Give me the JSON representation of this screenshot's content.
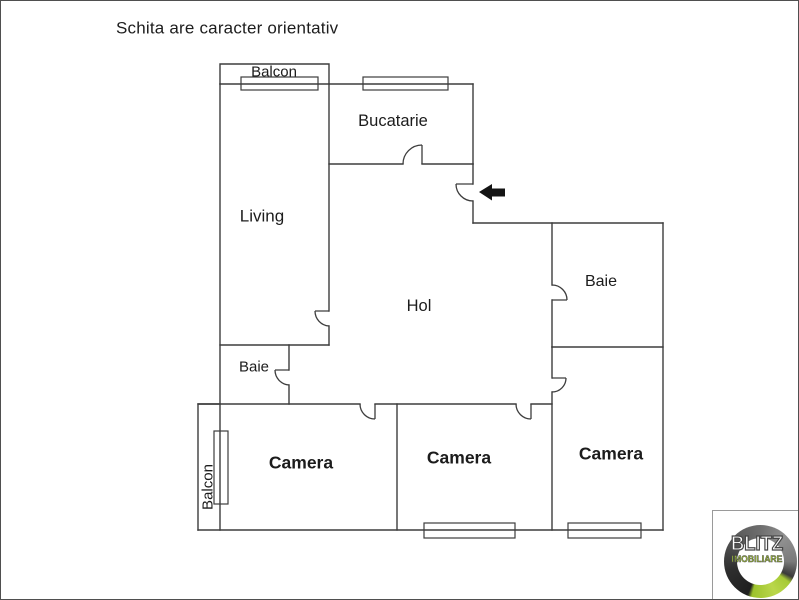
{
  "title": "Schita are caracter orientativ",
  "rooms": {
    "balcon_top": {
      "label": "Balcon"
    },
    "bucatarie": {
      "label": "Bucatarie"
    },
    "living": {
      "label": "Living"
    },
    "hol": {
      "label": "Hol"
    },
    "baie_mica": {
      "label": "Baie"
    },
    "baie": {
      "label": "Baie"
    },
    "camera_1": {
      "label": "Camera"
    },
    "camera_2": {
      "label": "Camera"
    },
    "camera_3": {
      "label": "Camera"
    },
    "balcon_bottom": {
      "label": "Balcon"
    }
  },
  "logo": {
    "brand": "BLITZ",
    "subbrand": "IMOBILIARE",
    "accent_green": "#a9cc37",
    "ring_dark": "#3c3c3c"
  },
  "colors": {
    "wall": "#3d3d3d",
    "text": "#1c1c1c",
    "arrow": "#141414",
    "border": "#4f4f4f",
    "background": "#ffffff"
  }
}
